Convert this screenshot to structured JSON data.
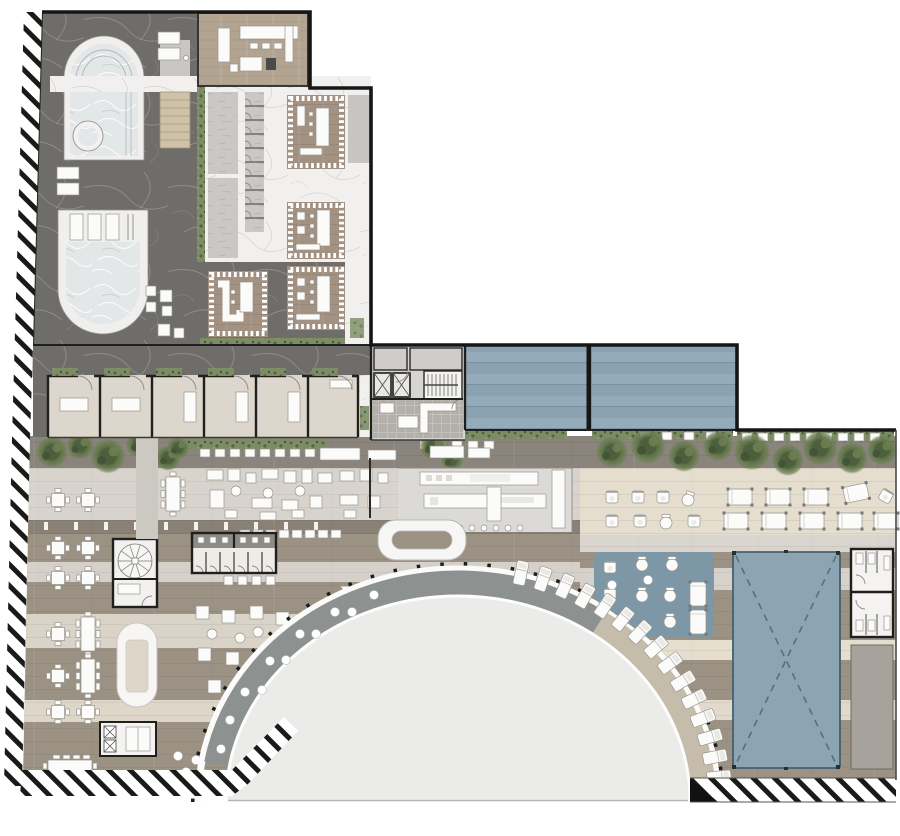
{
  "meta": {
    "title": "Resort floor plan — spa wing, cabana rooms and pool terrace with semicircular plaza",
    "drawing_type": "architectural plan view",
    "visible_text": "none"
  },
  "palette": {
    "paper": "#ffffff",
    "ink": "#161616",
    "wall": "#1f1f1e",
    "marbleDark": "#6e6d6a",
    "marbleLight": "#f1f0ee",
    "veinLight": "#d8d5d1",
    "woodRoom": "#b3a391",
    "woodTreat": "#a39182",
    "tatami": "#cfc2a8",
    "woodTerrace": "#9c9284",
    "terraceLight": "#d8d4cd",
    "terraceBeige": "#e5ddcd",
    "terraceDark": "#8a8176",
    "water": "#e3e7e8",
    "panelBlue": "#8aa2b1",
    "deckBlue": "#7d97a6",
    "canopyBlue": "#8da5b3",
    "canopyDash": "#53707f",
    "discGray": "#ebebe9",
    "ringGray": "#8d9291",
    "ringTan": "#c6bcab",
    "hedgeGreen": "#7c8c64",
    "treeGreen": "#5d7145",
    "treeDark": "#44563a",
    "stallGray": "#cac8c5",
    "tileGray": "#b3afa9",
    "roomBeige": "#dcd6cc",
    "grayStrip": "#a7a29c",
    "balconyGray": "#c7c5c1",
    "coreGray": "#d7d5d1",
    "kitchenGray": "#dbdad7",
    "furnWhite": "#fbfbf9",
    "furnStroke": "#98958f"
  },
  "inventory": {
    "treatment_rooms": 4,
    "cabana_rooms": 6,
    "skylight_panels": 2,
    "elevators": 2,
    "arc_sunloungers": 15,
    "ring_dot_tables": 11,
    "dining_tables_4seat": 8,
    "dining_tables_8seat": 2,
    "long_tables": 2,
    "spa_pools": 3,
    "shade_canopy": 1,
    "blue_relax_deck": 1
  },
  "regions": [
    {
      "id": "spa-wing",
      "desc": "dark marble spa with arched pool, round tub, U-pool"
    },
    {
      "id": "treatment-zone",
      "desc": "white marble, 4 wood treatment rooms, changing stalls"
    },
    {
      "id": "upper-lounge-room",
      "desc": "wood floor lounge with counters"
    },
    {
      "id": "cabana-row",
      "desc": "6 beige cabana rooms off dark corridor"
    },
    {
      "id": "skylight-panels",
      "desc": "two blue glazed panels"
    },
    {
      "id": "core",
      "desc": "elevators, stair, service room"
    },
    {
      "id": "terrace",
      "desc": "wood plank terrace with dining, lounge, bar, kitchen"
    },
    {
      "id": "plaza-arc",
      "desc": "semicircular plaza with walkway ring, ticks, loungers"
    },
    {
      "id": "relax-deck",
      "desc": "blue polygon deck with seating"
    },
    {
      "id": "pool-canopy",
      "desc": "large blue rectangle with dashed X"
    },
    {
      "id": "site-hatch",
      "desc": "diagonal hatch site boundary"
    }
  ]
}
